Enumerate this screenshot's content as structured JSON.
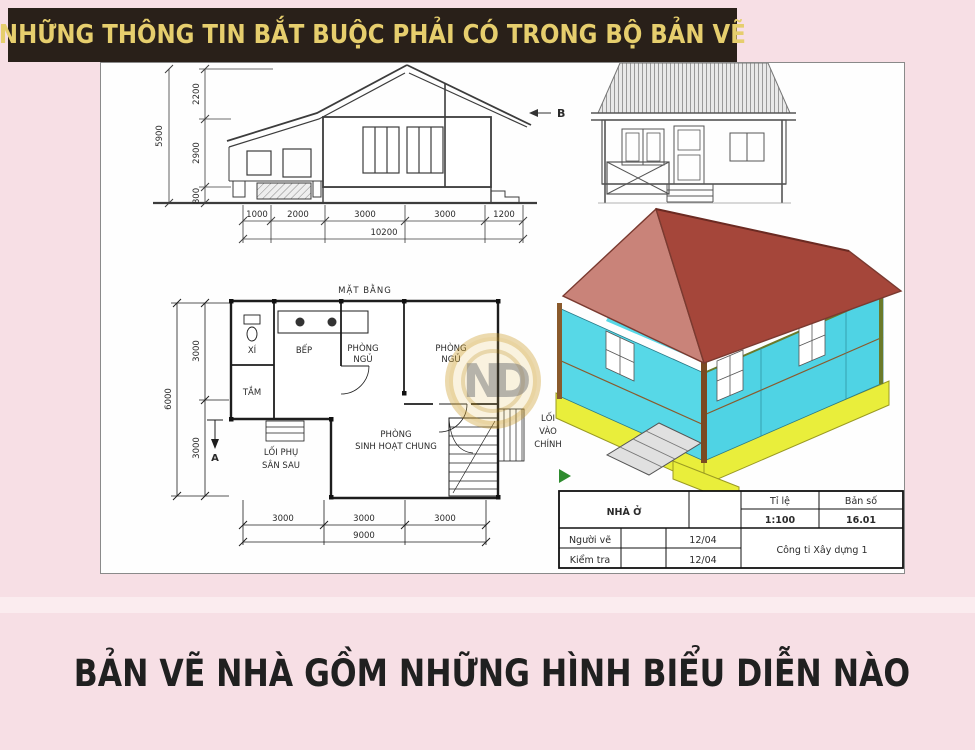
{
  "banner": {
    "title": "NHỮNG THÔNG TIN BẮT BUỘC PHẢI CÓ TRONG BỘ BẢN VẼ"
  },
  "footer": {
    "title": "BẢN VẼ NHÀ GỒM NHỮNG HÌNH BIỂU DIỄN NÀO"
  },
  "sheet": {
    "section_view": {
      "dims_vertical_total": "5900",
      "dims_vertical": [
        "2200",
        "2900",
        "800"
      ],
      "dims_bottom": [
        "1000",
        "2000",
        "3000",
        "3000",
        "1200"
      ],
      "dims_bottom_total": "10200"
    },
    "front_elevation": {
      "marker": "B"
    },
    "floor_plan": {
      "title": "MẶT BẰNG",
      "rooms": {
        "toilet": "XÍ",
        "bath": "TẮM",
        "kitchen": "BẾP",
        "bedroom": [
          "PHÒNG",
          "NGỦ"
        ],
        "living": [
          "PHÒNG",
          "SINH HOẠT CHUNG"
        ]
      },
      "annotations": {
        "side_entry": [
          "LỐI PHỤ",
          "SÂN SAU"
        ],
        "main_entry": [
          "LỐI",
          "VÀO",
          "CHÍNH"
        ],
        "section_marker": "A"
      },
      "dims_left_total": "6000",
      "dims_left": [
        "3000",
        "3000"
      ],
      "dims_bottom": [
        "3000",
        "3000",
        "3000"
      ],
      "dims_bottom_total": "9000"
    },
    "title_block": {
      "project": "NHÀ Ở",
      "scale_label": "Tỉ lệ",
      "scale_value": "1:100",
      "sheet_label": "Bản số",
      "sheet_value": "16.01",
      "drawn_label": "Người vẽ",
      "drawn_value": "12/04",
      "checked_label": "Kiểm tra",
      "checked_value": "12/04",
      "company": "Công ti Xây dựng 1"
    },
    "watermark": "ND"
  },
  "colors": {
    "page_bg": "#f7dfe5",
    "banner_bg": "#292019",
    "banner_text": "#e6ce6d",
    "roof_light": "#c98379",
    "roof_dark": "#a5463a",
    "wall_cyan": "#55d7e6",
    "base_yellow": "#e9ee3b",
    "watermark_gold": "#c9971f",
    "footer_text": "#202020"
  }
}
